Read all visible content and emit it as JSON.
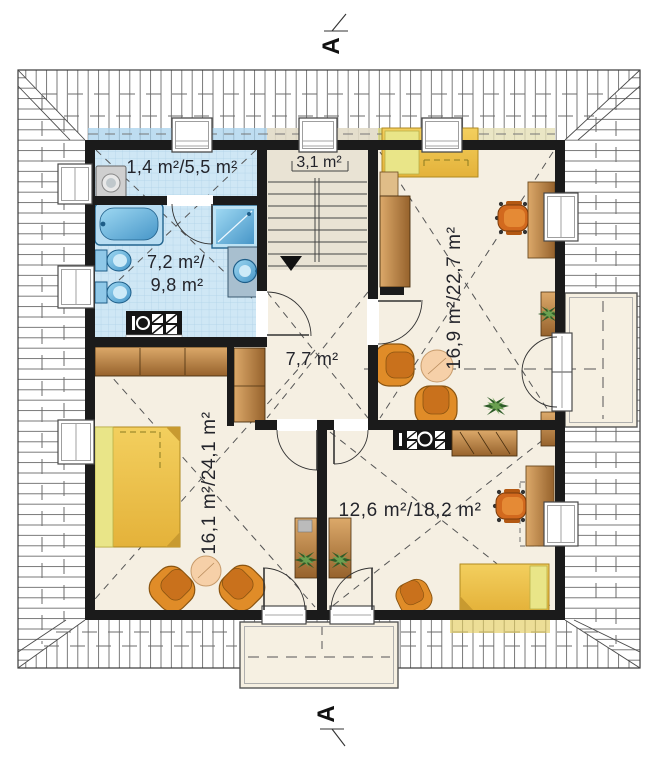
{
  "drawing": {
    "type": "attic-floor-plan",
    "section_marks": {
      "top_label": "A",
      "bottom_label": "A"
    },
    "rooms": {
      "laundry": {
        "label": "1,4 m²/5,5 m²"
      },
      "staircase": {
        "label": "3,1 m²"
      },
      "bathroom": {
        "label_line1": "7,2 m²/",
        "label_line2": "9,8 m²"
      },
      "bedroom_right": {
        "label": "16,9 m²/22,7 m²"
      },
      "hall": {
        "label": "7,7 m²"
      },
      "bedroom_left": {
        "label": "16,1 m²/24,1 m²"
      },
      "bedroom_bottom_right": {
        "label": "12,6 m²/18,2 m²"
      }
    },
    "colors": {
      "wall": "#1b1b1b",
      "floor": "#f5efe2",
      "tile": "#cfe7f5",
      "hatch_line": "#6b6b6b",
      "wood": "#c08a4e",
      "bed_yellow": "#eec84f",
      "chair_orange": "#e08c28",
      "fixture_blue": "#7cc4e8"
    }
  }
}
